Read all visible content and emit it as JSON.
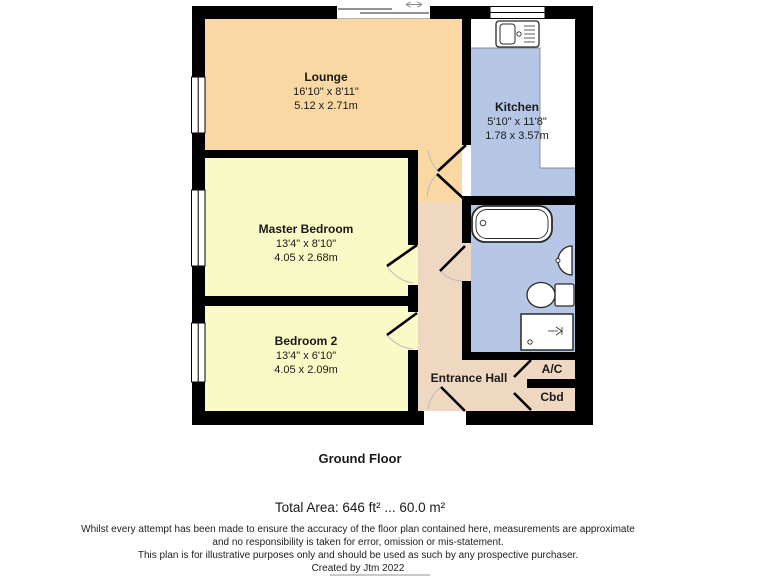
{
  "plan": {
    "rooms": [
      {
        "name": "Lounge",
        "dims_ft": "16'10\" x 8'11\"",
        "dims_m": "5.12 x 2.71m"
      },
      {
        "name": "Kitchen",
        "dims_ft": "5'10\" x 11'8\"",
        "dims_m": "1.78 x 3.57m"
      },
      {
        "name": "Master Bedroom",
        "dims_ft": "13'4\" x 8'10\"",
        "dims_m": "4.05 x 2.68m"
      },
      {
        "name": "Bedroom 2",
        "dims_ft": "13'4\" x 6'10\"",
        "dims_m": "4.05 x 2.09m"
      },
      {
        "name": "Entrance Hall"
      }
    ],
    "closets": [
      {
        "label": "A/C"
      },
      {
        "label": "Cbd"
      }
    ],
    "colors": {
      "lounge": "#F9D8A3",
      "bedrooms": "#FAFAC6",
      "kitchen_bathroom": "#B5C7E4",
      "hall": "#EFD8C2",
      "walls": "#000000",
      "fixtures": "#FFFFFF"
    }
  },
  "footer": {
    "floor_title": "Ground Floor",
    "total_area": "Total Area: 646 ft² ... 60.0 m²",
    "disclaimer": [
      "Whilst every attempt has been made to ensure the accuracy of the floor plan contained here, measurements are approximate",
      "and no responsibility is taken for error, omission or mis-statement.",
      "This plan is for illustrative purposes only and should be used as such by any prospective purchaser.",
      "Created by Jtm 2022"
    ]
  }
}
